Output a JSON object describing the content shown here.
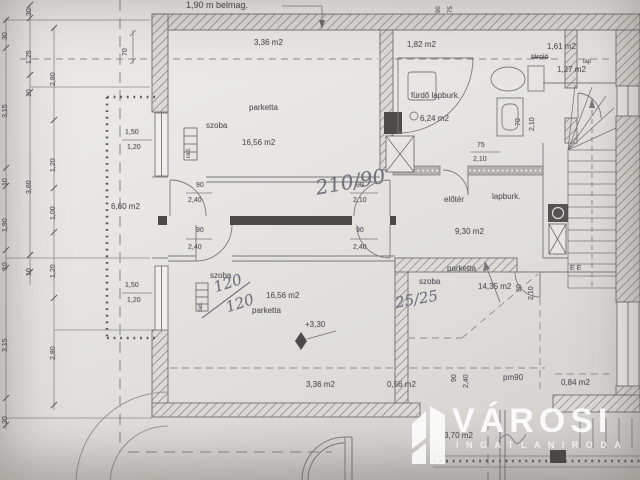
{
  "document": {
    "kind": "architectural floor plan (attic storey), photographed drawing",
    "language": "Hungarian"
  },
  "watermark": {
    "title": "VÁROSI",
    "subtitle": "INGATLANIRODA",
    "logo": "building-logo"
  },
  "rooms": [
    {
      "name": "szoba (upper left)",
      "floor": "parketta",
      "area": "16,56 m2",
      "low_headroom_area": "3,36 m2"
    },
    {
      "name": "fürdő",
      "floor": "lapburk.",
      "area": "6,24 m2",
      "low_headroom_area": "1,82 m2"
    },
    {
      "name": "tároló",
      "floor": "lap",
      "area": "1,27 m2",
      "low_headroom_area": "1,61 m2"
    },
    {
      "name": "előtér",
      "floor": "lapburk.",
      "area": "9,30 m2"
    },
    {
      "name": "közlekedő",
      "area": "6,60 m2"
    },
    {
      "name": "szoba (lower left)",
      "floor": "parketta",
      "area": "16,56 m2",
      "level": "+3,30",
      "low_headroom_area": "3,36 m2"
    },
    {
      "name": "szoba (lower right)",
      "floor": "parketta",
      "area": "14,35 m2",
      "low_headroom_areas": [
        "0,56 m2",
        "0,84 m2"
      ]
    },
    {
      "name": "erkély/terasz",
      "area": "3,70 m2"
    }
  ],
  "labels": [
    {
      "n": "dim-belmag",
      "t": "1,90 m belmag.",
      "x": 186,
      "y": 1,
      "s": 9
    },
    {
      "n": "area-upper-strip",
      "t": "3,36 m2",
      "x": 254,
      "y": 39,
      "s": 8
    },
    {
      "n": "floor-upper-room",
      "t": "parketta",
      "x": 249,
      "y": 104,
      "s": 8
    },
    {
      "n": "room-upper",
      "t": "szoba",
      "x": 206,
      "y": 122,
      "s": 8
    },
    {
      "n": "area-upper-room",
      "t": "16,56 m2",
      "x": 242,
      "y": 139,
      "s": 8
    },
    {
      "n": "area-bath-strip",
      "t": "1,82 m2",
      "x": 407,
      "y": 41,
      "s": 8
    },
    {
      "n": "room-bath",
      "t": "fürdő lapburk.",
      "x": 411,
      "y": 92,
      "s": 8
    },
    {
      "n": "area-bath",
      "t": "6,24 m2",
      "x": 420,
      "y": 115,
      "s": 8
    },
    {
      "n": "area-storage-strip",
      "t": "1,61 m2",
      "x": 547,
      "y": 43,
      "s": 8
    },
    {
      "n": "room-storage",
      "t": "tároló",
      "x": 531,
      "y": 54,
      "s": 7,
      "c": "strike"
    },
    {
      "n": "floor-storage",
      "t": "lap",
      "x": 583,
      "y": 59,
      "s": 6
    },
    {
      "n": "area-storage",
      "t": "1,27 m2",
      "x": 557,
      "y": 66,
      "s": 8
    },
    {
      "n": "door-bath-width",
      "t": "75",
      "x": 477,
      "y": 142,
      "s": 7
    },
    {
      "n": "door-bath-height",
      "t": "2,10",
      "x": 473,
      "y": 156,
      "s": 7
    },
    {
      "n": "room-hall",
      "t": "előtér",
      "x": 444,
      "y": 196,
      "s": 8
    },
    {
      "n": "floor-hall",
      "t": "lapburk.",
      "x": 492,
      "y": 193,
      "s": 8
    },
    {
      "n": "area-hall",
      "t": "9,30 m2",
      "x": 455,
      "y": 228,
      "s": 8
    },
    {
      "n": "area-corridor",
      "t": "6,60 m2",
      "x": 111,
      "y": 203,
      "s": 8
    },
    {
      "n": "door-dim",
      "t": "90",
      "x": 196,
      "y": 182,
      "s": 7
    },
    {
      "n": "door-dim",
      "t": "2,40",
      "x": 188,
      "y": 197,
      "s": 7
    },
    {
      "n": "door-dim",
      "t": "90",
      "x": 196,
      "y": 227,
      "s": 7
    },
    {
      "n": "door-dim",
      "t": "2,40",
      "x": 188,
      "y": 244,
      "s": 7
    },
    {
      "n": "door-dim",
      "t": "90",
      "x": 356,
      "y": 182,
      "s": 7
    },
    {
      "n": "door-dim",
      "t": "2,10",
      "x": 353,
      "y": 197,
      "s": 7
    },
    {
      "n": "door-dim",
      "t": "90",
      "x": 356,
      "y": 227,
      "s": 7
    },
    {
      "n": "door-dim",
      "t": "2,40",
      "x": 353,
      "y": 244,
      "s": 7
    },
    {
      "n": "window-dim",
      "t": "1,50",
      "x": 125,
      "y": 129,
      "s": 7
    },
    {
      "n": "window-dim",
      "t": "1,20",
      "x": 127,
      "y": 144,
      "s": 7
    },
    {
      "n": "window-dim",
      "t": "1,50",
      "x": 125,
      "y": 282,
      "s": 7
    },
    {
      "n": "window-dim",
      "t": "1,20",
      "x": 127,
      "y": 297,
      "s": 7
    },
    {
      "n": "room-lower",
      "t": "szoba",
      "x": 210,
      "y": 272,
      "s": 8
    },
    {
      "n": "area-lower-room",
      "t": "16,56 m2",
      "x": 266,
      "y": 292,
      "s": 8
    },
    {
      "n": "floor-lower-room",
      "t": "parketta",
      "x": 252,
      "y": 307,
      "s": 8
    },
    {
      "n": "level-value",
      "t": "+3,30",
      "x": 305,
      "y": 321,
      "s": 8
    },
    {
      "n": "floor-br-room",
      "t": "parketta",
      "x": 447,
      "y": 265,
      "s": 8
    },
    {
      "n": "room-br",
      "t": "szoba",
      "x": 419,
      "y": 278,
      "s": 8
    },
    {
      "n": "area-br-room",
      "t": "14,35 m2",
      "x": 478,
      "y": 283,
      "s": 8
    },
    {
      "n": "area-lower-strip",
      "t": "3,36 m2",
      "x": 306,
      "y": 381,
      "s": 8
    },
    {
      "n": "area-strip2",
      "t": "0,56 m2",
      "x": 387,
      "y": 381,
      "s": 8
    },
    {
      "n": "parapet-dim",
      "t": "pm90",
      "x": 503,
      "y": 374,
      "s": 8
    },
    {
      "n": "area-strip3",
      "t": "0,84 m2",
      "x": 561,
      "y": 379,
      "s": 8
    },
    {
      "n": "area-balcony",
      "t": "3,70 m2",
      "x": 444,
      "y": 432,
      "s": 8
    },
    {
      "n": "meter-marks",
      "t": "E  E",
      "x": 570,
      "y": 265,
      "s": 7
    },
    {
      "n": "dim-rot",
      "t": "70",
      "x": 122,
      "y": 56,
      "s": 7,
      "c": "rot"
    },
    {
      "n": "dim-rot",
      "t": "30",
      "x": 2,
      "y": 40,
      "s": 7,
      "c": "rot"
    },
    {
      "n": "dim-rot",
      "t": "3,15",
      "x": 2,
      "y": 118,
      "s": 7,
      "c": "rot"
    },
    {
      "n": "dim-rot",
      "t": "10",
      "x": 2,
      "y": 186,
      "s": 7,
      "c": "rot"
    },
    {
      "n": "dim-rot",
      "t": "1,90",
      "x": 2,
      "y": 232,
      "s": 7,
      "c": "rot"
    },
    {
      "n": "dim-rot",
      "t": "10",
      "x": 2,
      "y": 270,
      "s": 7,
      "c": "rot"
    },
    {
      "n": "dim-rot",
      "t": "3,15",
      "x": 2,
      "y": 352,
      "s": 7,
      "c": "rot"
    },
    {
      "n": "dim-rot",
      "t": "30",
      "x": 2,
      "y": 424,
      "s": 7,
      "c": "rot"
    },
    {
      "n": "dim-rot",
      "t": "30",
      "x": 26,
      "y": 16,
      "s": 7,
      "c": "rot"
    },
    {
      "n": "dim-rot",
      "t": "1,25",
      "x": 26,
      "y": 64,
      "s": 7,
      "c": "rot"
    },
    {
      "n": "dim-rot",
      "t": "10",
      "x": 26,
      "y": 97,
      "s": 7,
      "c": "rot"
    },
    {
      "n": "dim-rot",
      "t": "3,60",
      "x": 26,
      "y": 194,
      "s": 7,
      "c": "rot"
    },
    {
      "n": "dim-rot",
      "t": "10",
      "x": 26,
      "y": 276,
      "s": 7,
      "c": "rot"
    },
    {
      "n": "dim-rot",
      "t": "2,80",
      "x": 50,
      "y": 86,
      "s": 7,
      "c": "rot"
    },
    {
      "n": "dim-rot",
      "t": "1,20",
      "x": 50,
      "y": 172,
      "s": 7,
      "c": "rot"
    },
    {
      "n": "dim-rot",
      "t": "1,00",
      "x": 50,
      "y": 220,
      "s": 7,
      "c": "rot"
    },
    {
      "n": "dim-rot",
      "t": "1,20",
      "x": 50,
      "y": 278,
      "s": 7,
      "c": "rot"
    },
    {
      "n": "dim-rot",
      "t": "2,80",
      "x": 50,
      "y": 360,
      "s": 7,
      "c": "rot"
    },
    {
      "n": "dim-rot",
      "t": "90",
      "x": 436,
      "y": 13,
      "s": 6,
      "c": "rot"
    },
    {
      "n": "dim-rot",
      "t": "75",
      "x": 448,
      "y": 13,
      "s": 6,
      "c": "rot"
    },
    {
      "n": "door-dim-rot",
      "t": "70",
      "x": 515,
      "y": 126,
      "s": 7,
      "c": "rot"
    },
    {
      "n": "door-dim-rot",
      "t": "2,10",
      "x": 529,
      "y": 131,
      "s": 7,
      "c": "rot"
    },
    {
      "n": "door-dim-rot",
      "t": "90",
      "x": 516,
      "y": 292,
      "s": 7,
      "c": "rot"
    },
    {
      "n": "door-dim-rot",
      "t": "2,10",
      "x": 528,
      "y": 300,
      "s": 7,
      "c": "rot"
    },
    {
      "n": "door-dim-rot",
      "t": "90",
      "x": 451,
      "y": 382,
      "s": 7,
      "c": "rot"
    },
    {
      "n": "door-dim-rot",
      "t": "2,40",
      "x": 463,
      "y": 388,
      "s": 7,
      "c": "rot"
    },
    {
      "n": "radiator-label",
      "t": "rad.",
      "x": 186,
      "y": 158,
      "s": 6,
      "c": "rot"
    },
    {
      "n": "radiator-label",
      "t": "rad.",
      "x": 198,
      "y": 312,
      "s": 6,
      "c": "rot"
    },
    {
      "n": "handwritten-door-note",
      "t": "210/90",
      "x": 314,
      "y": 178,
      "r": -10,
      "s": 20,
      "c": "hand"
    },
    {
      "n": "handwritten-window-note",
      "t": "120",
      "x": 212,
      "y": 281,
      "r": -18,
      "s": 15,
      "c": "hand"
    },
    {
      "n": "handwritten-window-note",
      "t": "120",
      "x": 224,
      "y": 301,
      "r": -18,
      "s": 15,
      "c": "hand"
    },
    {
      "n": "handwritten-window-note",
      "t": "25/25",
      "x": 394,
      "y": 296,
      "r": -10,
      "s": 15,
      "c": "hand"
    }
  ]
}
